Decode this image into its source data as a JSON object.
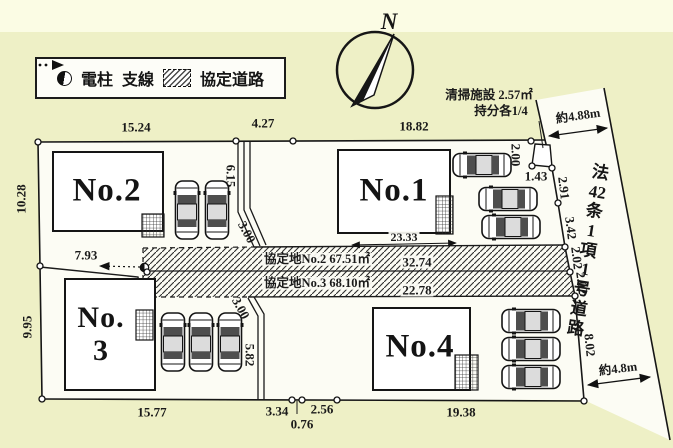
{
  "legend": {
    "items": [
      {
        "label": "電柱"
      },
      {
        "label": "支線"
      },
      {
        "label": "協定道路"
      }
    ]
  },
  "compass": {
    "north": "N"
  },
  "site": {
    "lots": {
      "no1": "No.1",
      "no2": "No.2",
      "no3_line1": "No.",
      "no3_line2": "3",
      "no4": "No.4"
    },
    "agreement_road": {
      "upper_label": "協定地No.2 67.51㎡",
      "upper_length": "32.74",
      "lower_label": "協定地No.3 68.10㎡",
      "lower_length": "22.78"
    },
    "cleaning_facility": {
      "line1": "清掃施設 2.57㎡",
      "line2": "持分各1/4",
      "height": "2.00",
      "width": "1.43"
    },
    "road": {
      "name_segments": [
        "法",
        "42",
        "条",
        "1",
        "項",
        "1",
        "号",
        "道",
        "路"
      ],
      "width_top": "約4.88m",
      "width_bottom": "約4.8m"
    },
    "dimensions": {
      "north_edge": [
        "15.24",
        "4.27",
        "18.82"
      ],
      "west_edge": [
        "10.28",
        "9.95"
      ],
      "south_edge": [
        "15.77",
        "3.34",
        "0.76",
        "2.56",
        "19.38"
      ],
      "east_edge": [
        "2.91",
        "3.42",
        "2.02",
        "2.02",
        "8.02"
      ],
      "no1_south": "23.33",
      "no2_south": "7.93",
      "upper_walkway": {
        "length": "6.15",
        "width": "3.00"
      },
      "lower_walkway": {
        "length": "5.82",
        "width": "3.00"
      }
    }
  }
}
